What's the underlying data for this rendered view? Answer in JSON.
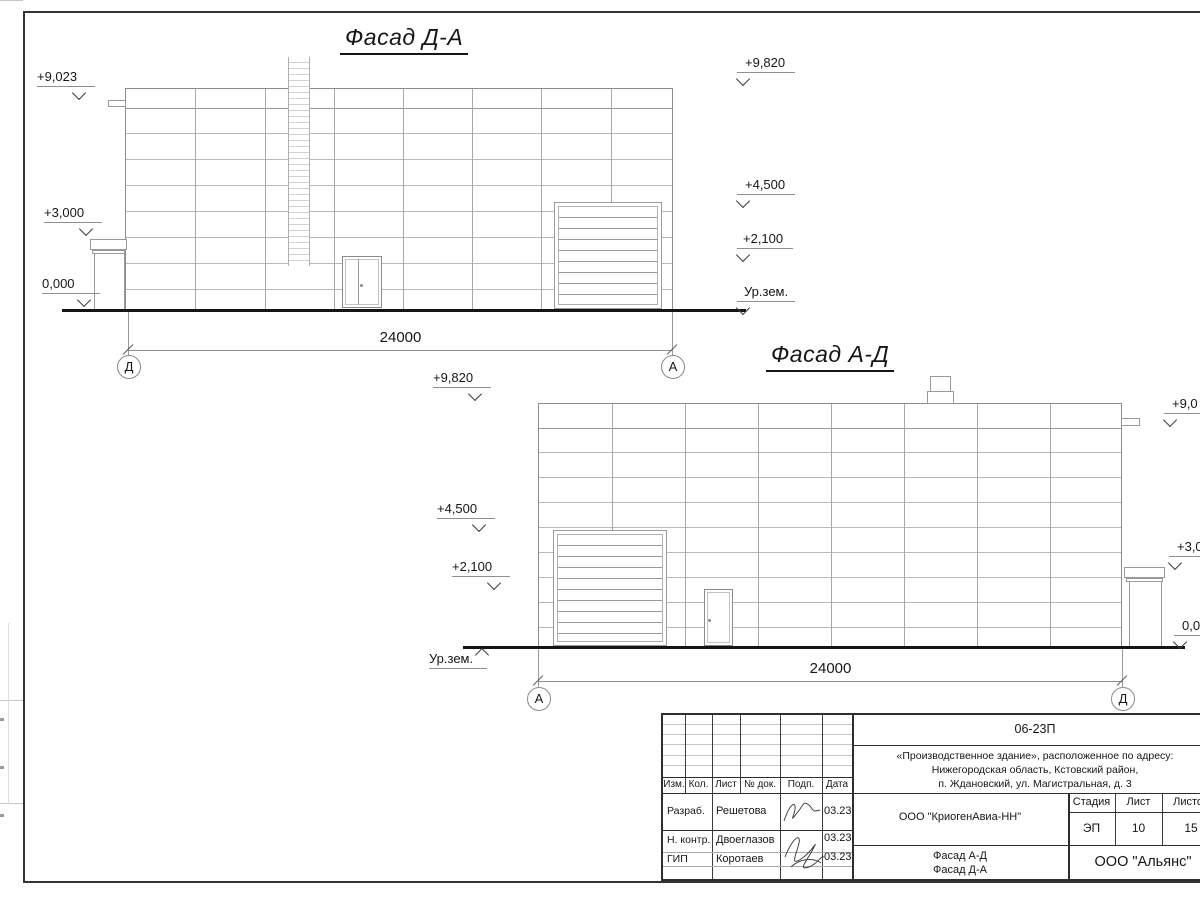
{
  "facade_da": {
    "title": "Фасад Д-А",
    "dimension_label": "24000",
    "axis_left": "Д",
    "axis_right": "А",
    "left_marks": [
      "+9,023",
      "+3,000",
      "0,000"
    ],
    "right_marks": [
      "+9,820",
      "+4,500",
      "+2,100",
      "Ур.зем."
    ]
  },
  "facade_ad": {
    "title": "Фасад А-Д",
    "dimension_label": "24000",
    "axis_left": "А",
    "axis_right": "Д",
    "left_marks": [
      "+9,820",
      "+4,500",
      "+2,100",
      "Ур.зем."
    ],
    "right_marks": [
      "+9,0",
      "+3,0",
      "0,0"
    ]
  },
  "title_block": {
    "project_code": "06-23П",
    "address_lines": [
      "«Производственное здание», расположенное по адресу:",
      "Нижегородская область, Кстовский район,",
      "п. Ждановский, ул. Магистральная, д. 3"
    ],
    "revision_headers": [
      "Изм.",
      "Кол.",
      "Лист",
      "№ док.",
      "Подп.",
      "Дата"
    ],
    "staff_rows": [
      {
        "role": "Разраб.",
        "name": "Решетова",
        "date": "03.23"
      },
      {
        "role": "Н. контр.",
        "name": "Двоеглазов",
        "date": "03.23"
      },
      {
        "role": "ГИП",
        "name": "Коротаев",
        "date": "03.23"
      }
    ],
    "organization": "ООО \"КриогенАвиа-НН\"",
    "stage_headers": [
      "Стадия",
      "Лист",
      "Листов"
    ],
    "stage_values": [
      "ЭП",
      "10",
      "15"
    ],
    "sheet_title_lines": [
      "Фасад А-Д",
      "Фасад Д-А"
    ],
    "company": "ООО \"Альянс\""
  }
}
